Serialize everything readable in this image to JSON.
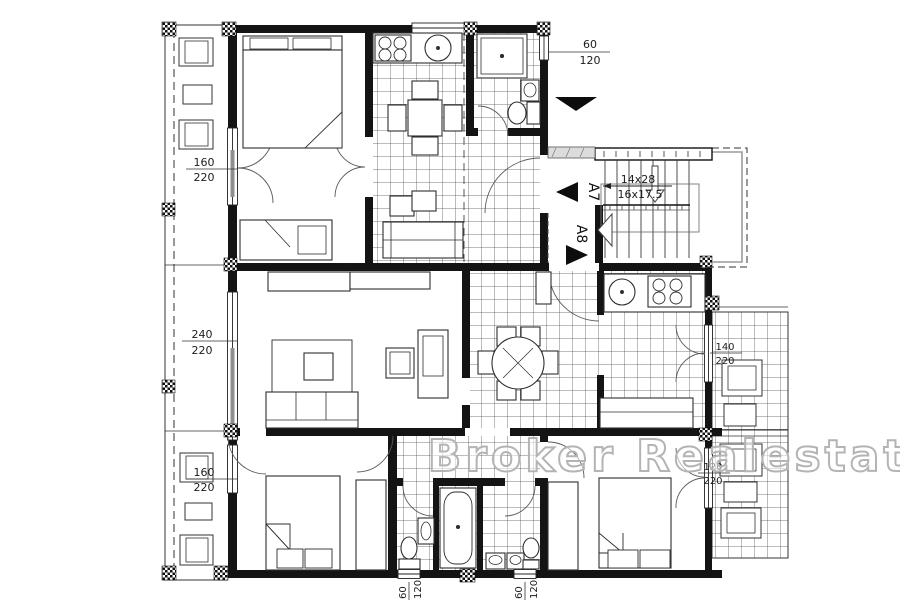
{
  "plan": {
    "watermark": "Broker Realestate",
    "stairs": {
      "riser_label": "14x28",
      "tread_label": "16x17.5"
    },
    "units": {
      "a7": "A7",
      "a8": "A8"
    },
    "dims": {
      "balcony_door_top_left": {
        "num": "160",
        "den": "220"
      },
      "living_window": {
        "num": "240",
        "den": "220"
      },
      "balcony_door_bottom_left": {
        "num": "160",
        "den": "220"
      },
      "entry_window": {
        "num": "60",
        "den": "120"
      },
      "kitchen_balcony_door": {
        "num": "140",
        "den": "220"
      },
      "bedroom_balcony_door": {
        "num": "120",
        "den": "220"
      },
      "bath_window_left": {
        "num": "60",
        "den": "120"
      },
      "bath_window_right": {
        "num": "60",
        "den": "120"
      }
    },
    "colors": {
      "ink": "#141414",
      "tile_line": "#4d4d4d",
      "watermark": "#b4b4b4"
    }
  }
}
